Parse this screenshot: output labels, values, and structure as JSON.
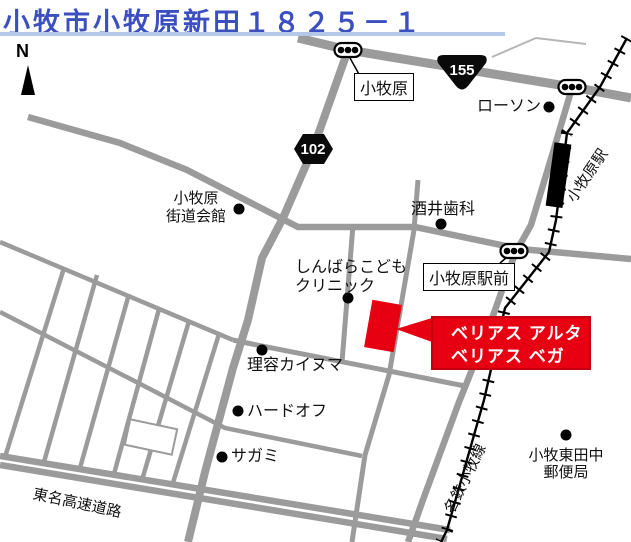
{
  "title": {
    "text": "小牧市小牧原新田１８２５－１"
  },
  "map": {
    "north_label": "N",
    "route_badges": [
      {
        "id": "route-155",
        "label": "155"
      },
      {
        "id": "route-102",
        "label": "102"
      }
    ],
    "boxed_labels": {
      "komakihara": "小牧原",
      "ekimae": "小牧原駅前"
    },
    "places": {
      "lawson": "ローソン",
      "sakai_dental": "酒井歯科",
      "kaido_hall_line1": "小牧原",
      "kaido_hall_line2": "街道会館",
      "shinbara_line1": "しんばらこども",
      "shinbara_line2": "クリニック",
      "rikai_barber": "理容カイヌマ",
      "hardoff": "ハードオフ",
      "sagami": "サガミ",
      "post_office_line1": "小牧東田中",
      "post_office_line2": "郵便局",
      "station": "小牧原駅",
      "meitetsu_line": "名鉄小牧線",
      "tomei_expressway": "東名高速道路"
    },
    "callout": {
      "line1": "ベリアス アルタ",
      "line2": "ベリアス ベガ"
    },
    "colors": {
      "title_blue": "#3c4fc1",
      "title_underline": "#b6c8e8",
      "road_gray": "#9b9b9b",
      "highlight_red": "#e60012",
      "callout_border": "#c30010"
    }
  }
}
